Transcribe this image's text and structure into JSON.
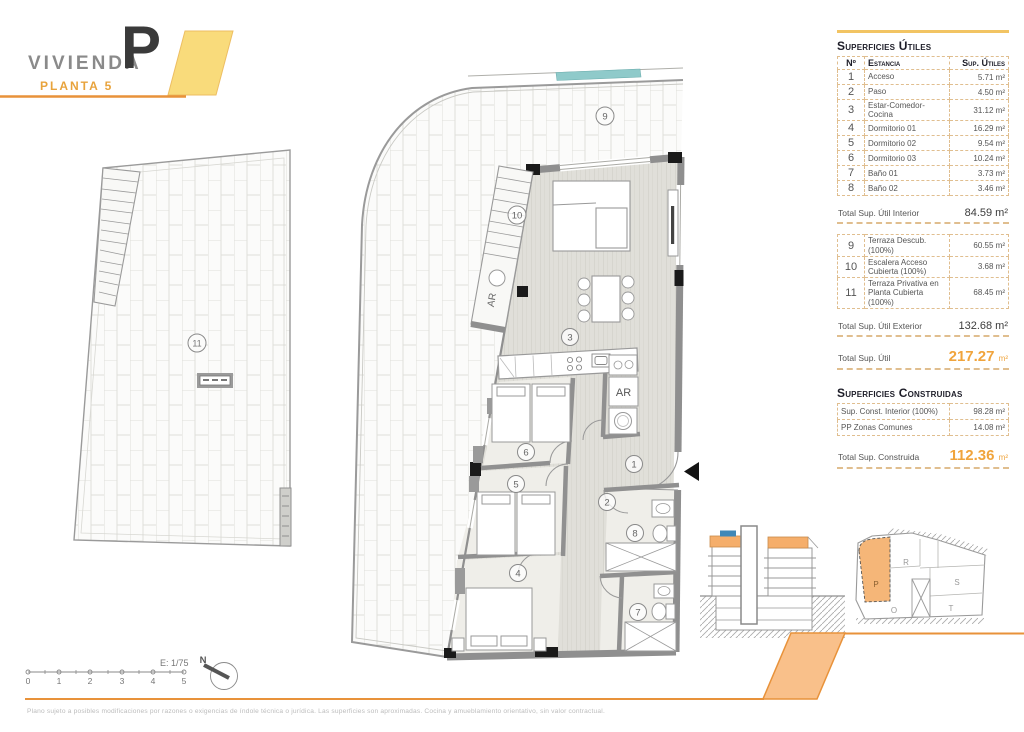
{
  "header": {
    "title": "VIVIENDA",
    "subtitle": "PLANTA 5",
    "unit_letter": "P"
  },
  "panel": {
    "utiles": {
      "heading": "Superficies Útiles",
      "col_num": "Nº",
      "col_room": "Estancia",
      "col_area": "Sup. Útiles",
      "rows": [
        {
          "num": "1",
          "name": "Acceso",
          "area": "5.71 m²"
        },
        {
          "num": "2",
          "name": "Paso",
          "area": "4.50 m²"
        },
        {
          "num": "3",
          "name": "Estar-Comedor-Cocina",
          "area": "31.12 m²"
        },
        {
          "num": "4",
          "name": "Dormitorio 01",
          "area": "16.29 m²"
        },
        {
          "num": "5",
          "name": "Dormitorio 02",
          "area": "9.54 m²"
        },
        {
          "num": "6",
          "name": "Dormitorio 03",
          "area": "10.24 m²"
        },
        {
          "num": "7",
          "name": "Baño 01",
          "area": "3.73 m²"
        },
        {
          "num": "8",
          "name": "Baño 02",
          "area": "3.46 m²"
        }
      ],
      "total_interior_label": "Total Sup. Útil Interior",
      "total_interior_value": "84.59 m²",
      "exterior_rows": [
        {
          "num": "9",
          "name": "Terraza Descub.(100%)",
          "area": "60.55 m²"
        },
        {
          "num": "10",
          "name": "Escalera Acceso Cubierta (100%)",
          "area": "3.68 m²"
        },
        {
          "num": "11",
          "name": "Terraza Privativa en Planta Cubierta (100%)",
          "area": "68.45 m²"
        }
      ],
      "total_exterior_label": "Total Sup. Útil Exterior",
      "total_exterior_value": "132.68 m²",
      "total_label": "Total Sup. Útil",
      "total_value": "217.27",
      "total_unit": "m²"
    },
    "construidas": {
      "heading": "Superficies Construidas",
      "rows": [
        {
          "name": "Sup. Const. Interior (100%)",
          "area": "98.28 m²"
        },
        {
          "name": "PP Zonas Comunes",
          "area": "14.08 m²"
        }
      ],
      "total_label": "Total Sup. Construida",
      "total_value": "112.36",
      "total_unit": "m²"
    }
  },
  "plan": {
    "rooms": {
      "n1": "1",
      "n2": "2",
      "n3": "3",
      "n4": "4",
      "n5": "5",
      "n6": "6",
      "n7": "7",
      "n8": "8",
      "n9": "9",
      "n10": "10",
      "n11": "11"
    },
    "ar_closet": "AR",
    "ar_stair": "AR"
  },
  "keyplan": {
    "p": "P",
    "r": "R",
    "s": "S",
    "o": "O",
    "t": "T"
  },
  "footer": {
    "scale_label": "E: 1/75",
    "ticks": [
      "0",
      "1",
      "2",
      "3",
      "4",
      "5"
    ],
    "north_label": "N",
    "disclaimer": "Plano sujeto a posibles modificaciones por razones o exigencias de índole técnica o jurídica. Las superficies son aproximadas. Cocina y amueblamiento orientativo, sin valor contractual."
  },
  "colors": {
    "accent_orange": "#E8923A",
    "total_orange": "#F0A43C",
    "band_yellow": "#F9DB7B",
    "band_fill": "#F9C08A",
    "highlight_unit": "#F5B678"
  }
}
